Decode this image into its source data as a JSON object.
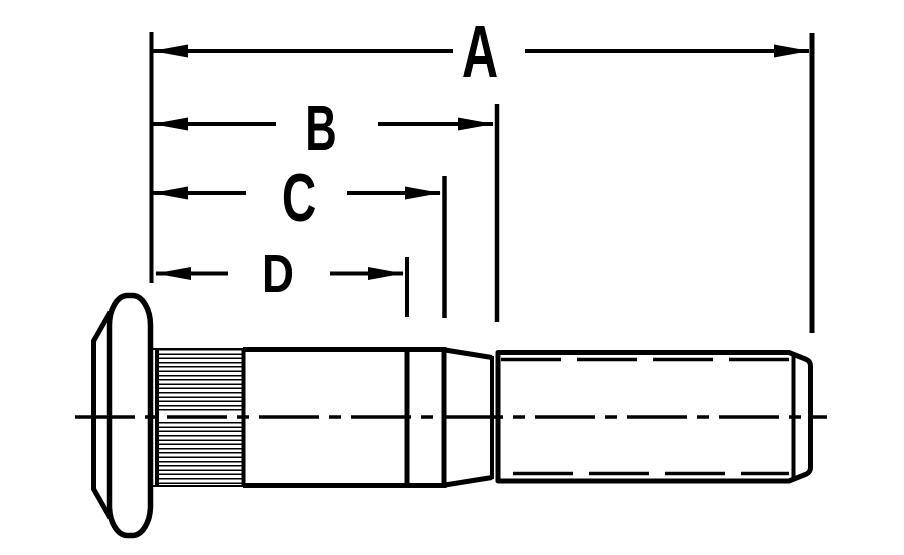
{
  "drawing": {
    "subject": "wheel-stud-side-view-with-dimension-callouts",
    "background_color": "#ffffff",
    "line_color": "#000000",
    "dimensions": [
      {
        "label": "A"
      },
      {
        "label": "B"
      },
      {
        "label": "C"
      },
      {
        "label": "D"
      }
    ]
  }
}
